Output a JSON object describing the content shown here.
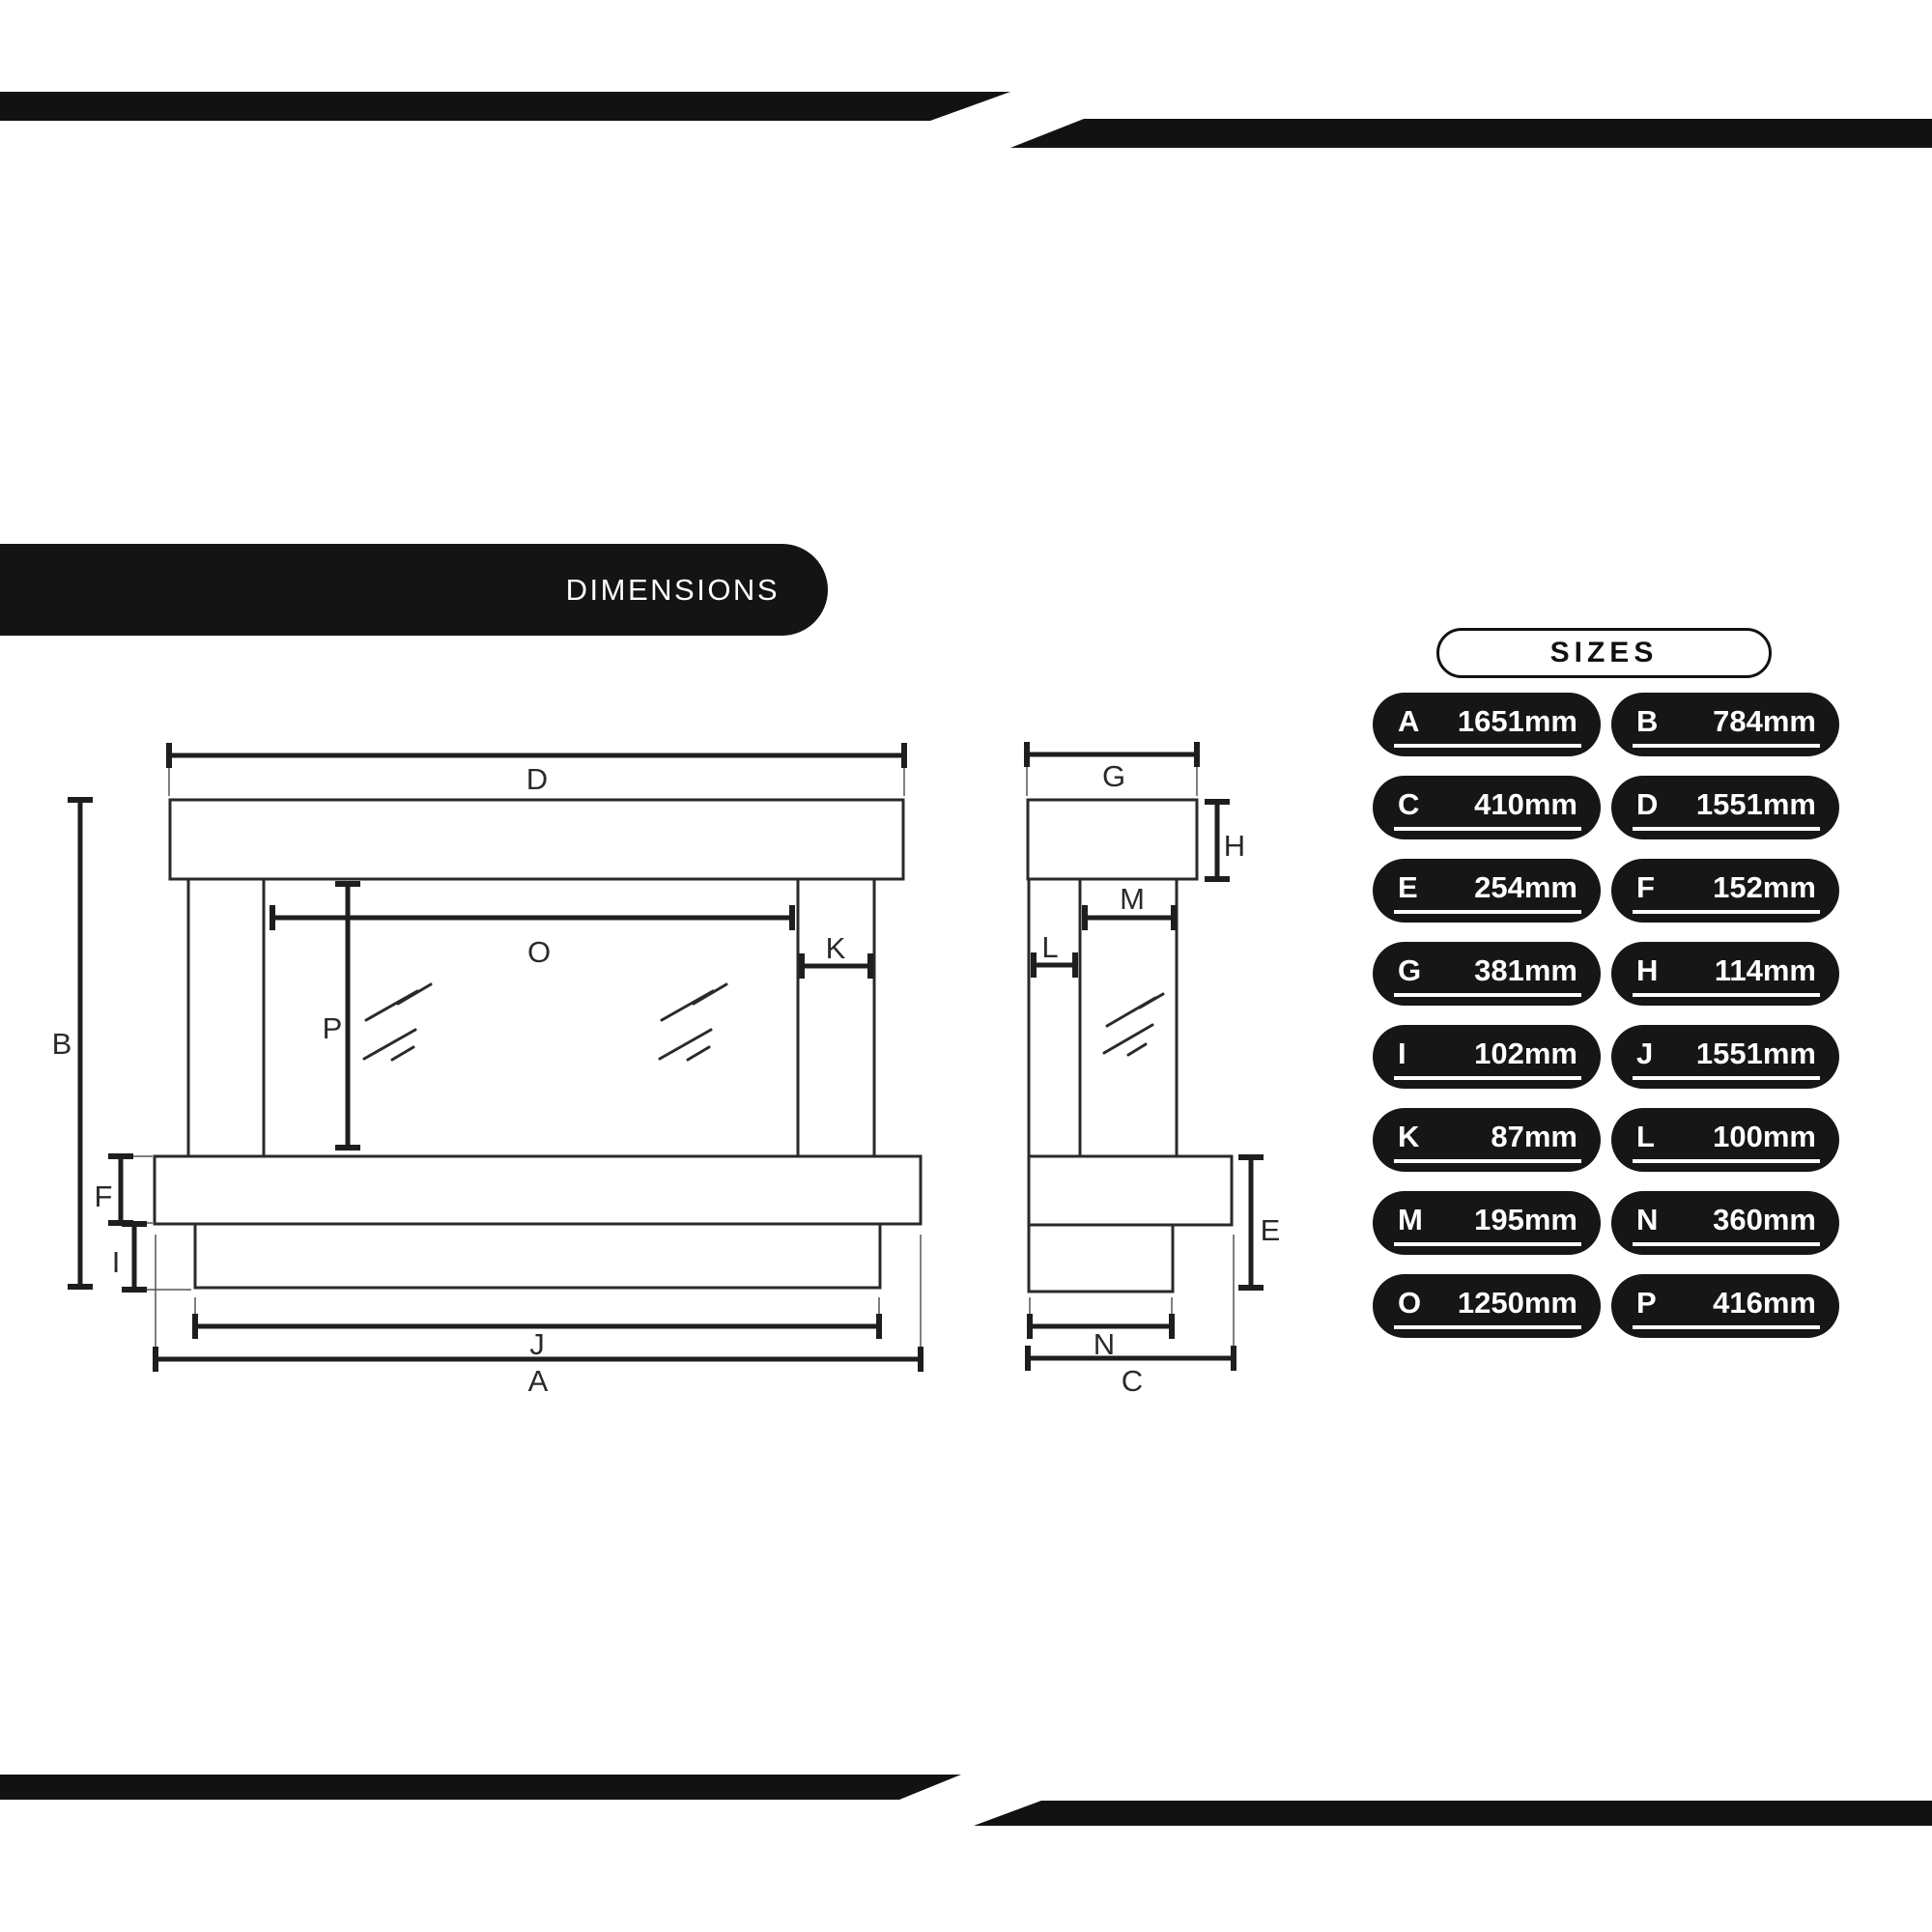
{
  "header": {
    "dimensions_label": "DIMENSIONS"
  },
  "sizes_panel": {
    "title": "SIZES",
    "entries": [
      {
        "letter": "A",
        "value": "1651mm"
      },
      {
        "letter": "B",
        "value": "784mm"
      },
      {
        "letter": "C",
        "value": "410mm"
      },
      {
        "letter": "D",
        "value": "1551mm"
      },
      {
        "letter": "E",
        "value": "254mm"
      },
      {
        "letter": "F",
        "value": "152mm"
      },
      {
        "letter": "G",
        "value": "381mm"
      },
      {
        "letter": "H",
        "value": "114mm"
      },
      {
        "letter": "I",
        "value": "102mm"
      },
      {
        "letter": "J",
        "value": "1551mm"
      },
      {
        "letter": "K",
        "value": "87mm"
      },
      {
        "letter": "L",
        "value": "100mm"
      },
      {
        "letter": "M",
        "value": "195mm"
      },
      {
        "letter": "N",
        "value": "360mm"
      },
      {
        "letter": "O",
        "value": "1250mm"
      },
      {
        "letter": "P",
        "value": "416mm"
      }
    ]
  },
  "drawing": {
    "views": [
      "front-elevation",
      "side-elevation"
    ],
    "labels": {
      "A": "A",
      "B": "B",
      "C": "C",
      "D": "D",
      "E": "E",
      "F": "F",
      "G": "G",
      "H": "H",
      "I": "I",
      "J": "J",
      "K": "K",
      "L": "L",
      "M": "M",
      "N": "N",
      "O": "O",
      "P": "P"
    }
  },
  "colors": {
    "bar": "#121212",
    "heading_pill_bg": "#141414",
    "size_pill_bg": "#161616",
    "pill_text": "#ffffff",
    "drawing_line": "#2a2a2a"
  }
}
